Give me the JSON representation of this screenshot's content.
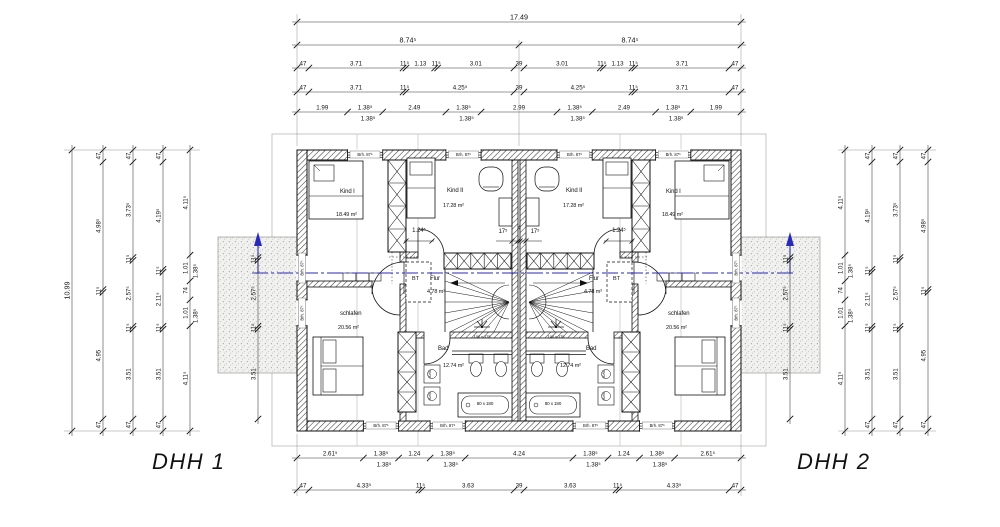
{
  "title": {
    "dhh1": "DHH 1",
    "dhh2": "DHH 2"
  },
  "rooms": {
    "kind1": {
      "name": "Kind I",
      "area": "18.49 m²"
    },
    "kind2": {
      "name": "Kind II",
      "area": "17.28 m²"
    },
    "flur": {
      "name": "Flur",
      "area": "4.78 m²"
    },
    "bad": {
      "name": "Bad",
      "area": "12.74 m²"
    },
    "schlafen": {
      "name": "schlafen",
      "area": "20.56 m²"
    },
    "bt": "BT"
  },
  "fixtures": {
    "roof_window": "100 x 175",
    "bathtub": "80 x 180",
    "washer": "60/60",
    "window_parapet": "Brh. 87⁵"
  },
  "inline_dims": {
    "door_width": "1.24⁵",
    "party_wall": "17⁵",
    "party_gap": "4"
  },
  "colors": {
    "line": "#111111",
    "section_line": "#2a2ab8",
    "construction": "#c9c9c7"
  },
  "dim_chains": {
    "top": [
      {
        "labels": [
          "17.49"
        ]
      },
      {
        "labels": [
          "8.74⁵",
          "8.74⁵"
        ]
      },
      {
        "labels": [
          "47",
          "3.71",
          "11⁵",
          "1.13",
          "11⁵",
          "3.01",
          "39",
          "3.01",
          "11⁵",
          "1.13",
          "11⁵",
          "3.71",
          "47"
        ]
      },
      {
        "labels": [
          "47",
          "3.71",
          "11⁵",
          "4.25⁵",
          "39",
          "4.25⁵",
          "11⁵",
          "3.71",
          "47"
        ]
      },
      {
        "labels": [
          "1.99",
          "1.38⁵",
          "2.49",
          "1.38⁵",
          "2.99",
          "1.38⁵",
          "2.49",
          "1.38⁵",
          "1.99"
        ],
        "sub": [
          "",
          "1.38⁵",
          "",
          "1.38⁵",
          "",
          "1.38⁵",
          "",
          "1.38⁵",
          ""
        ]
      }
    ],
    "bottom": [
      {
        "labels": [
          "2.61⁵",
          "1.38⁵",
          "1.24",
          "1.38⁵",
          "4.24",
          "1.38⁵",
          "1.24",
          "1.38⁵",
          "2.61⁵"
        ],
        "sub": [
          "",
          "1.38⁵",
          "",
          "1.38⁵",
          "",
          "1.38⁵",
          "",
          "1.38⁵",
          ""
        ]
      },
      {
        "labels": [
          "47",
          "4.33⁵",
          "11⁵",
          "3.63",
          "39",
          "3.63",
          "11⁵",
          "4.33⁵",
          "47"
        ]
      }
    ],
    "left": [
      {
        "labels": [
          "10.99"
        ]
      },
      {
        "labels": [
          "47",
          "4.98⁵",
          "11⁵",
          "4.95",
          "47"
        ]
      },
      {
        "labels": [
          "47",
          "3.73⁵",
          "11⁵",
          "2.57⁵",
          "11⁵",
          "3.51",
          "47"
        ]
      },
      {
        "labels": [
          "47",
          "4.19⁵",
          "11⁵",
          "2.11⁵",
          "11⁵",
          "3.51",
          "47"
        ]
      },
      {
        "labels": [
          "4.11⁵",
          "1.01",
          "74",
          "1.01",
          "4.11⁵"
        ],
        "sub": [
          "",
          "1.38⁵",
          "",
          "1.38⁵",
          ""
        ]
      },
      {
        "labels": [
          "11⁵",
          "2.57⁵",
          "11⁵",
          "3.51"
        ]
      }
    ],
    "right": [
      {
        "labels": [
          "11⁵",
          "2.57⁵",
          "11⁵",
          "3.51"
        ]
      },
      {
        "labels": [
          "4.11⁵",
          "1.01",
          "74",
          "1.01",
          "4.11⁵"
        ],
        "sub": [
          "",
          "1.38⁵",
          "",
          "1.38⁵",
          ""
        ]
      },
      {
        "labels": [
          "47",
          "4.19⁵",
          "11⁵",
          "2.11⁵",
          "11⁵",
          "3.51",
          "47"
        ]
      },
      {
        "labels": [
          "47",
          "3.73⁵",
          "11⁵",
          "2.57⁵",
          "11⁵",
          "3.51",
          "47"
        ]
      },
      {
        "labels": [
          "47",
          "4.98⁵",
          "11⁵",
          "4.95",
          "47"
        ]
      }
    ]
  }
}
